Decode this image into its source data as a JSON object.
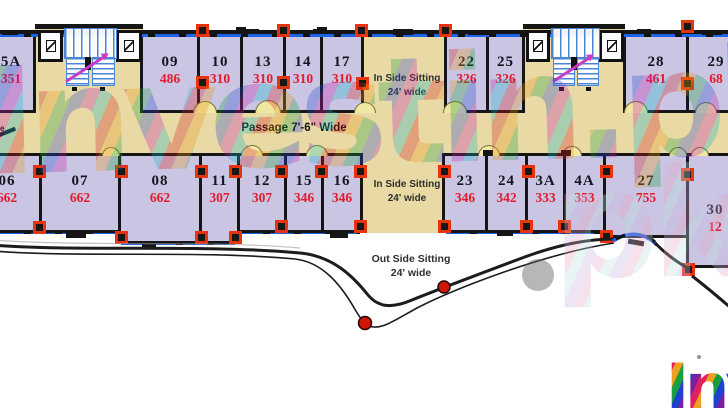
{
  "labels": {
    "passage": "Passage 7'-6\" Wide",
    "inside_sitting_top": {
      "l1": "In Side Sitting",
      "l2": "24' wide"
    },
    "inside_sitting_bottom": {
      "l1": "In Side Sitting",
      "l2": "24' wide"
    },
    "outside_sitting": {
      "l1": "Out Side Sitting",
      "l2": "24' wide"
    },
    "edge_fragment": "e"
  },
  "rooms_top": [
    {
      "no": "5A",
      "area": "351"
    },
    {
      "no": "09",
      "area": "486"
    },
    {
      "no": "10",
      "area": "310"
    },
    {
      "no": "13",
      "area": "310"
    },
    {
      "no": "14",
      "area": "310"
    },
    {
      "no": "17",
      "area": "310"
    },
    {
      "no": "22",
      "area": "326"
    },
    {
      "no": "25",
      "area": "326"
    },
    {
      "no": "28",
      "area": "461"
    },
    {
      "no": "29",
      "area": "68"
    }
  ],
  "rooms_bottom": [
    {
      "no": "06",
      "area": "662"
    },
    {
      "no": "07",
      "area": "662"
    },
    {
      "no": "08",
      "area": "662"
    },
    {
      "no": "11",
      "area": "307"
    },
    {
      "no": "12",
      "area": "307"
    },
    {
      "no": "15",
      "area": "346"
    },
    {
      "no": "16",
      "area": "346"
    },
    {
      "no": "23",
      "area": "346"
    },
    {
      "no": "24",
      "area": "342"
    },
    {
      "no": "3A",
      "area": "333"
    },
    {
      "no": "4A",
      "area": "353"
    },
    {
      "no": "27",
      "area": "755"
    },
    {
      "no": "30",
      "area": "12"
    }
  ],
  "watermark": {
    "text": "Investin.pk",
    "ghost_text": "pk",
    "corner_text": "Inv"
  },
  "colors": {
    "room_fill": "#c9c5e2",
    "corridor_tan": "#e8d9a5",
    "wall": "#161616",
    "window_blue": "#1d63e6",
    "area_red": "#e41a2c",
    "connector_red": "#e8340c",
    "door_arc": "#f0e7a2",
    "terrace_dot_red": "#cf1505",
    "stairs_blue": "#4a85d6",
    "arrow_magenta": "#c83cc8"
  }
}
